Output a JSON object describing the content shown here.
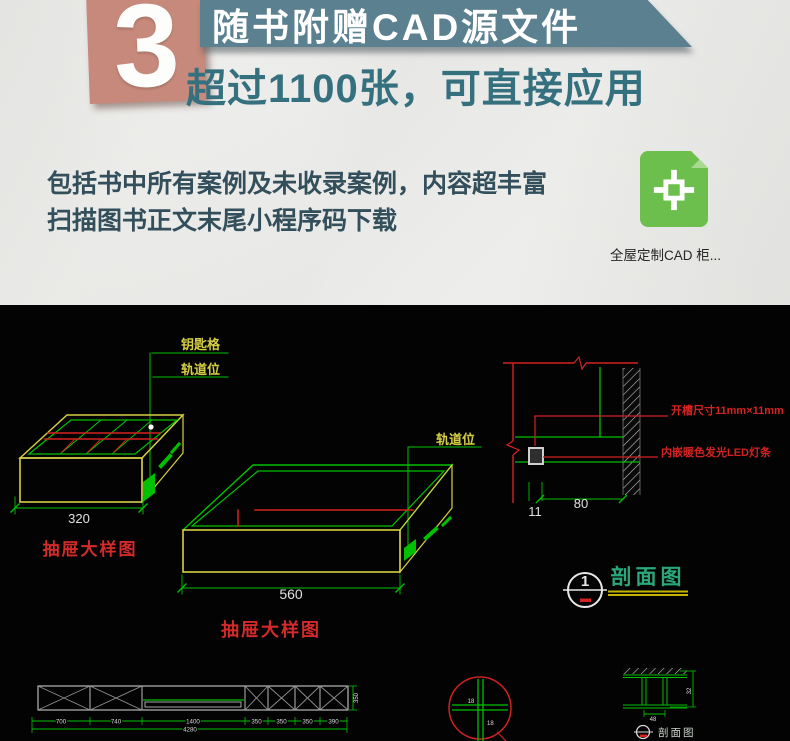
{
  "header": {
    "badge_number": "3",
    "banner_title": "随书附赠CAD源文件",
    "headline": "超过1100张，可直接应用",
    "body_lines": [
      "包括书中所有案例及未收录案例，内容超丰富",
      "扫描图书正文末尾小程序码下载"
    ],
    "file_caption": "全屋定制CAD  柜..."
  },
  "colors": {
    "badge_bg": "#c6897b",
    "banner_bg": "#5b8090",
    "headline_text": "#35707f",
    "body_text": "#324f5b",
    "icon_green": "#6cbf4c",
    "cad_green": "#00c000",
    "cad_yellow": "#d6cf45",
    "cad_red": "#d42222",
    "cad_white": "#e0e0e0",
    "section_teal": "#2aa87c",
    "underline_yellow": "#c2b400"
  },
  "cad": {
    "left_drawer": {
      "label_key": "钥匙格",
      "label_track": "轨道位",
      "width_dim": "320",
      "caption": "抽屉大样图"
    },
    "mid_drawer": {
      "label_track": "轨道位",
      "width_dim": "560",
      "caption": "抽屉大样图"
    },
    "section_detail": {
      "groove_label": "开槽尺寸11mm×11mm",
      "led_label": "内嵌暖色发光LED灯条",
      "depth_dim": "80",
      "groove_dim": "11"
    },
    "section_marker": {
      "number": "1",
      "title": "剖面图"
    },
    "elevation": {
      "segments": [
        "700",
        "740",
        "1400",
        "350",
        "350",
        "350",
        "390"
      ],
      "total": "4280",
      "height_dim": "350"
    },
    "detail_circle": {
      "dim_a": "18",
      "dim_b": "18"
    },
    "mini_section": {
      "height_dim": "32",
      "width_dim": "48",
      "title": "剖面图"
    }
  }
}
